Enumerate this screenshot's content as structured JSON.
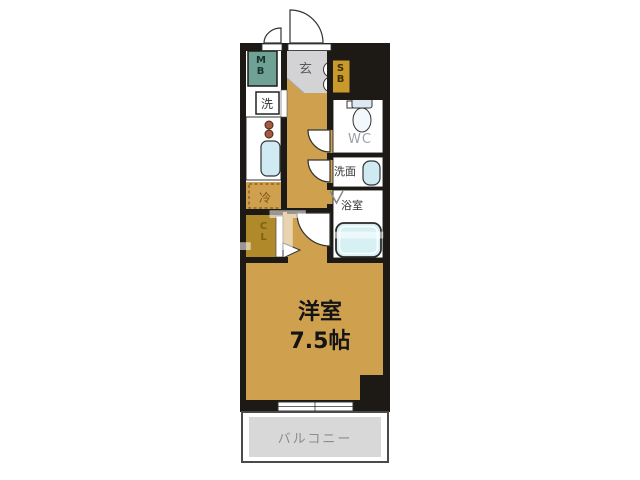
{
  "floorplan": {
    "labels": {
      "entrance": "玄",
      "meter_box": "MB",
      "shoe_box": "SB",
      "washing_machine": "洗",
      "refrigerator": "冷",
      "closet": "CL",
      "toilet_room": "WC",
      "washroom": "洗面",
      "bathroom": "浴室",
      "balcony": "バルコニー"
    },
    "main_room": {
      "name": "洋室",
      "size": "7.5帖"
    },
    "watermark": "ALT—B",
    "colors": {
      "wall": "#1d1915",
      "flooring": "#cfa14f",
      "closet": "#b08a2a",
      "entrance_floor": "#d3d2d4",
      "balcony": "#d8d8d8",
      "meter_box": "#6fa195",
      "shoe_box": "#c9992b",
      "fixtures": "#cfeaf2"
    }
  }
}
